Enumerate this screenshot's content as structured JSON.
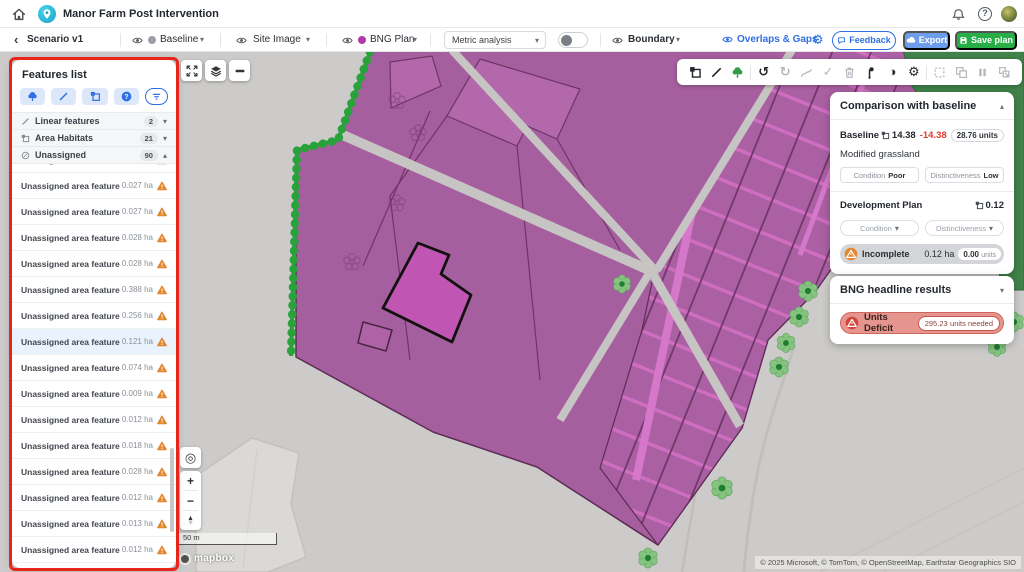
{
  "header": {
    "title": "Manor Farm Post Intervention"
  },
  "toolbar": {
    "scenario_label": "Scenario v1",
    "baseline_label": "Baseline",
    "site_image_label": "Site Image",
    "bng_plan_label": "BNG Plan",
    "metric_dropdown_label": "Metric analysis",
    "boundary_label": "Boundary",
    "overlaps_label": "Overlaps & Gaps",
    "feedback_label": "Feedback",
    "export_label": "Export",
    "save_label": "Save plan",
    "baseline_dot_color": "#9aa0a8",
    "bng_dot_color": "#b03ba3"
  },
  "features_panel": {
    "title": "Features list",
    "sections": [
      {
        "label": "Linear features",
        "count": "2"
      },
      {
        "label": "Area Habitats",
        "count": "21"
      },
      {
        "label": "Unassigned",
        "count": "90"
      }
    ],
    "item_label": "Unassigned area feature",
    "partial_item_area": "",
    "items": [
      "0.027 ha",
      "0.027 ha",
      "0.028 ha",
      "0.028 ha",
      "0.388 ha",
      "0.256 ha",
      "0.121 ha",
      "0.074 ha",
      "0.009 ha",
      "0.012 ha",
      "0.018 ha",
      "0.028 ha",
      "0.012 ha",
      "0.013 ha",
      "0.012 ha"
    ],
    "highlighted_index": 6
  },
  "comparison_panel": {
    "title": "Comparison with baseline",
    "baseline_label": "Baseline",
    "baseline_area": "14.38",
    "baseline_change": "-14.38",
    "baseline_units": "28.76 units",
    "habitat_name": "Modified grassland",
    "condition_label": "Condition",
    "condition_value": "Poor",
    "distinctiveness_label": "Distinctiveness",
    "distinctiveness_value": "Low",
    "dev_plan_label": "Development Plan",
    "dev_plan_area": "0.12",
    "condition_dropdown_label": "Condition",
    "distinctiveness_dropdown_label": "Distinctiveness",
    "status_label": "Incomplete",
    "status_area": "0.12 ha",
    "status_units_value": "0.00",
    "status_units_suffix": "units"
  },
  "bng_panel": {
    "title": "BNG headline results",
    "deficit_label": "Units Deficit",
    "deficit_value": "295.23",
    "deficit_suffix": "units needed"
  },
  "map": {
    "scale_label": "50 m",
    "logo_label": "mapbox",
    "attribution": "© 2025 Microsoft, © TomTom, © OpenStreetMap, Earthstar Geographics SIO"
  },
  "colors": {
    "accent_blue": "#2f6fe4",
    "export_blue": "#6d9deb",
    "save_green": "#27ae46",
    "habitat_purple": "#a65f9e",
    "selected_magenta": "#c155b3",
    "hedge_green": "#2aa23c",
    "warning_orange": "#e2862f",
    "deficit_red": "#d2453b",
    "annotation_red": "#e8251a"
  }
}
